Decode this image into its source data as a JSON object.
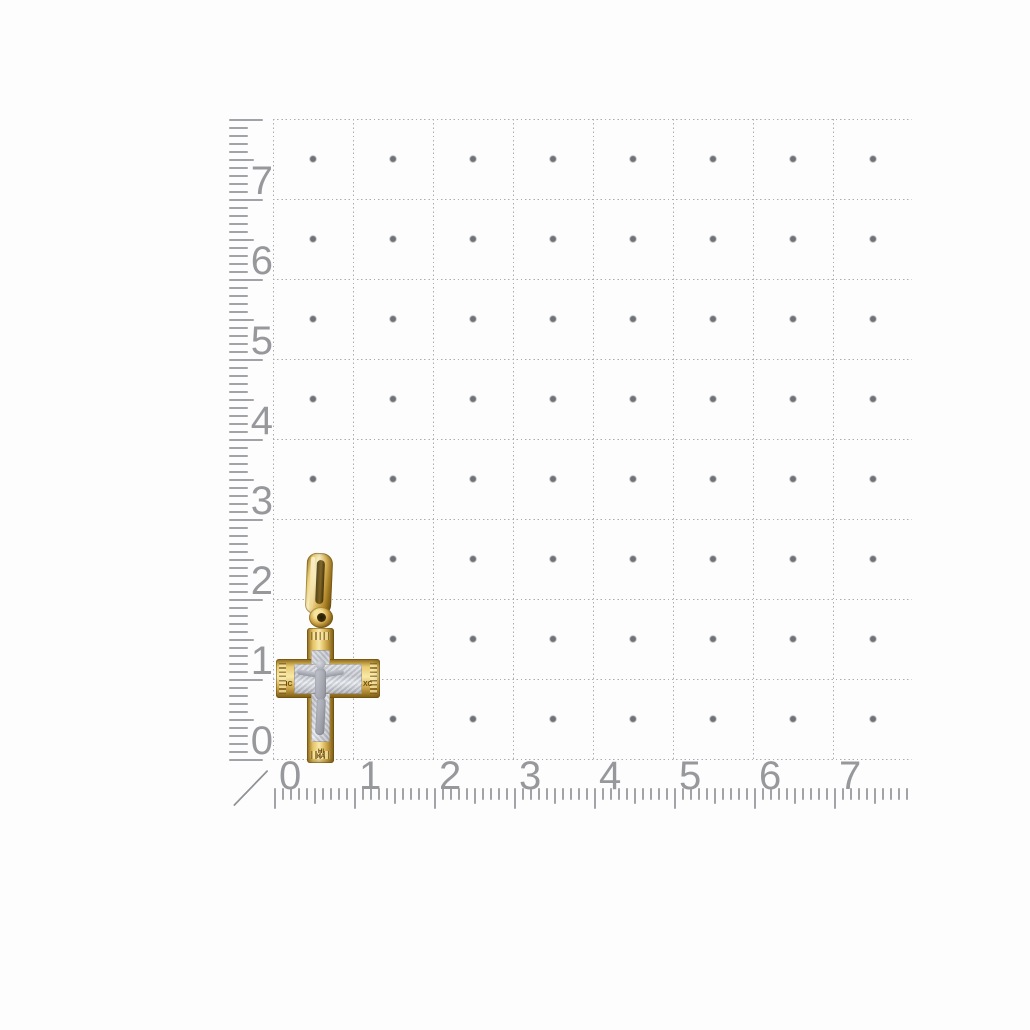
{
  "scene": {
    "background_color": "#fdfdfd"
  },
  "grid": {
    "columns": 8,
    "rows": 8,
    "line_color": "#a9adb2",
    "dot_color": "#6e7176"
  },
  "left_ruler": {
    "labels": [
      "7",
      "6",
      "5",
      "4",
      "3",
      "2",
      "1",
      "0"
    ],
    "number_color": "#96989c",
    "tick_color": "#a0a3a7"
  },
  "bottom_ruler": {
    "labels": [
      "0",
      "1",
      "2",
      "3",
      "4",
      "5",
      "6",
      "7"
    ],
    "number_color": "#96989c",
    "tick_color": "#a0a3a7"
  },
  "pendant": {
    "gold_light": "#f8e9a8",
    "gold_mid": "#d3ab4c",
    "gold_dark": "#7d5c15",
    "white_gold_light": "#e6e9ef",
    "white_gold_mid": "#bec1c9",
    "white_gold_dark": "#8f929b",
    "inscriptions": {
      "left_arm": "ІС",
      "right_arm": "ХС",
      "bottom": "НІ КА"
    }
  }
}
